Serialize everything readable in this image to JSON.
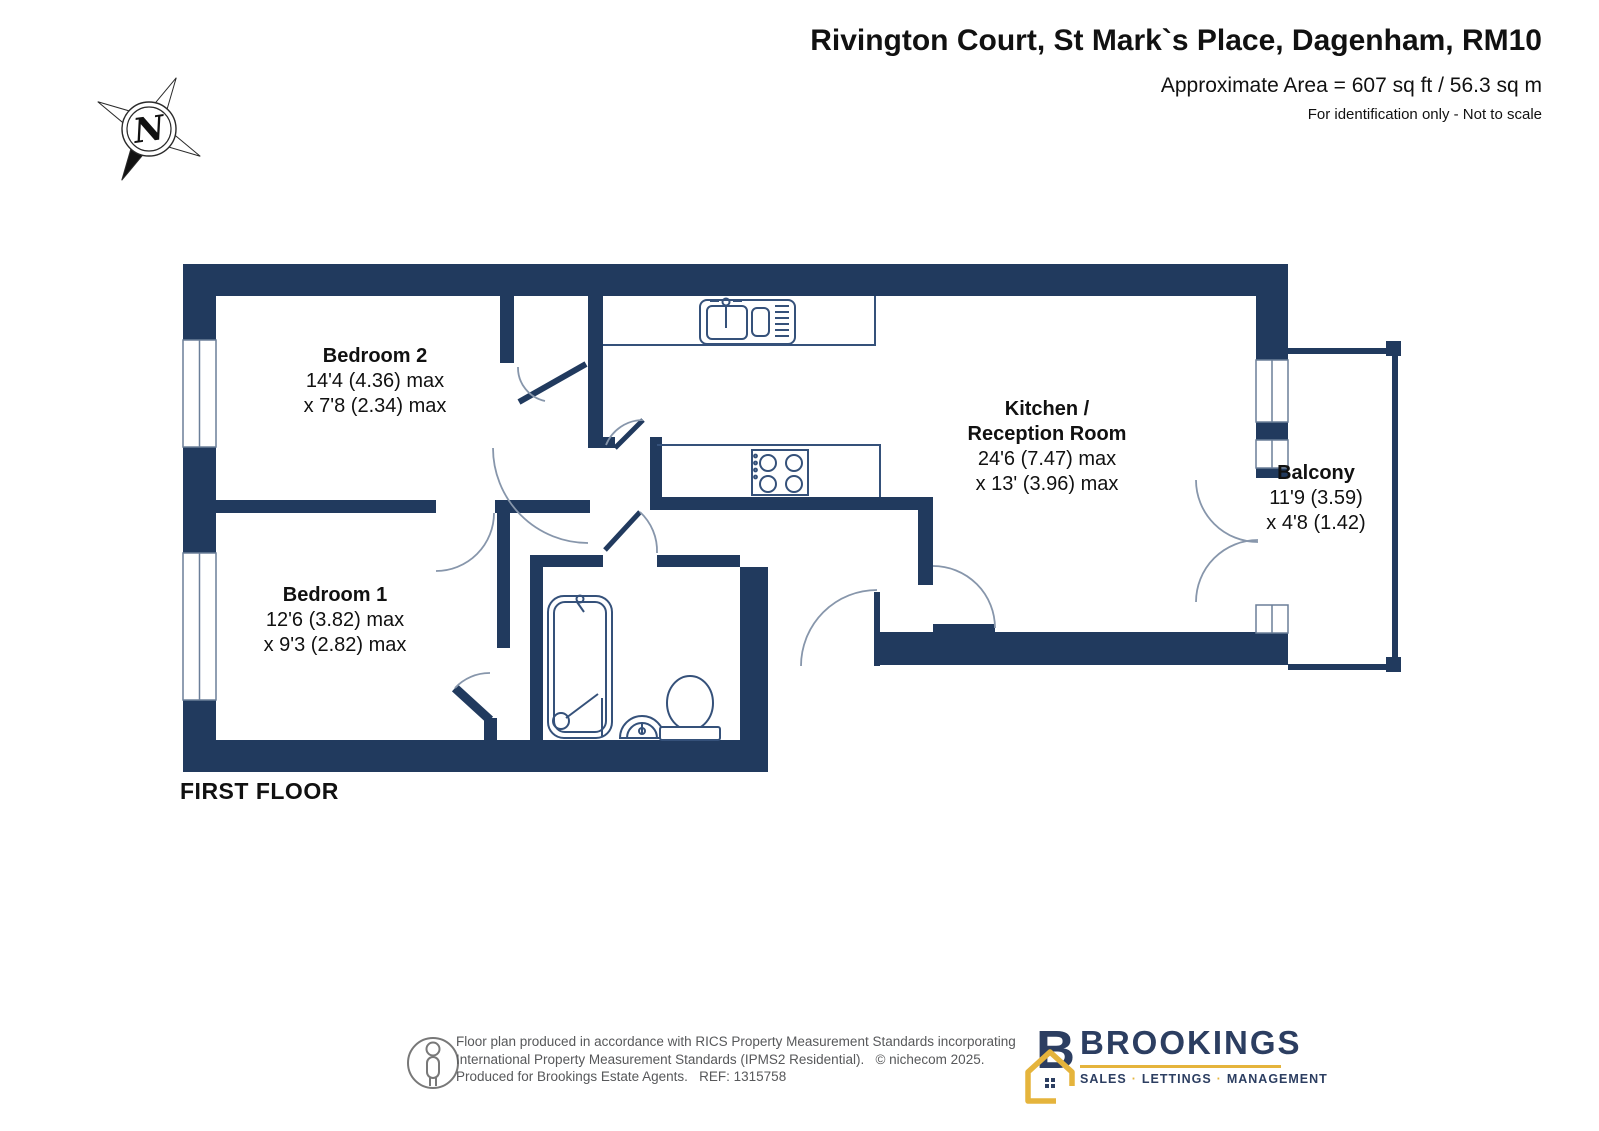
{
  "header": {
    "title": "Rivington Court, St Mark`s Place, Dagenham, RM10",
    "area": "Approximate Area = 607 sq ft / 56.3 sq m",
    "disclaimer": "For identification only - Not to scale"
  },
  "compass": {
    "label": "N"
  },
  "plan": {
    "floor_label": "FIRST FLOOR",
    "wall_color": "#213a5e",
    "rooms": [
      {
        "name": "Bedroom 2",
        "dim1": "14'4 (4.36) max",
        "dim2": "x 7'8 (2.34) max"
      },
      {
        "name": "Bedroom 1",
        "dim1": "12'6 (3.82) max",
        "dim2": "x 9'3 (2.82) max"
      },
      {
        "name_line1": "Kitchen /",
        "name_line2": "Reception Room",
        "dim1": "24'6 (7.47) max",
        "dim2": "x 13' (3.96) max"
      },
      {
        "name": "Balcony",
        "dim1": "11'9 (3.59)",
        "dim2": "x 4'8 (1.42)"
      }
    ]
  },
  "footer": {
    "line1": "Floor plan produced in accordance with RICS Property Measurement Standards incorporating",
    "line2": "International Property Measurement Standards (IPMS2 Residential).   © nichecom 2025.",
    "line3": "Produced for Brookings Estate Agents.   REF: 1315758"
  },
  "brand": {
    "name": "BROOKINGS",
    "separator": "·",
    "parts": [
      "SALES",
      "LETTINGS",
      "MANAGEMENT"
    ],
    "colors": {
      "navy": "#2c3e61",
      "gold": "#e5b43c"
    }
  }
}
